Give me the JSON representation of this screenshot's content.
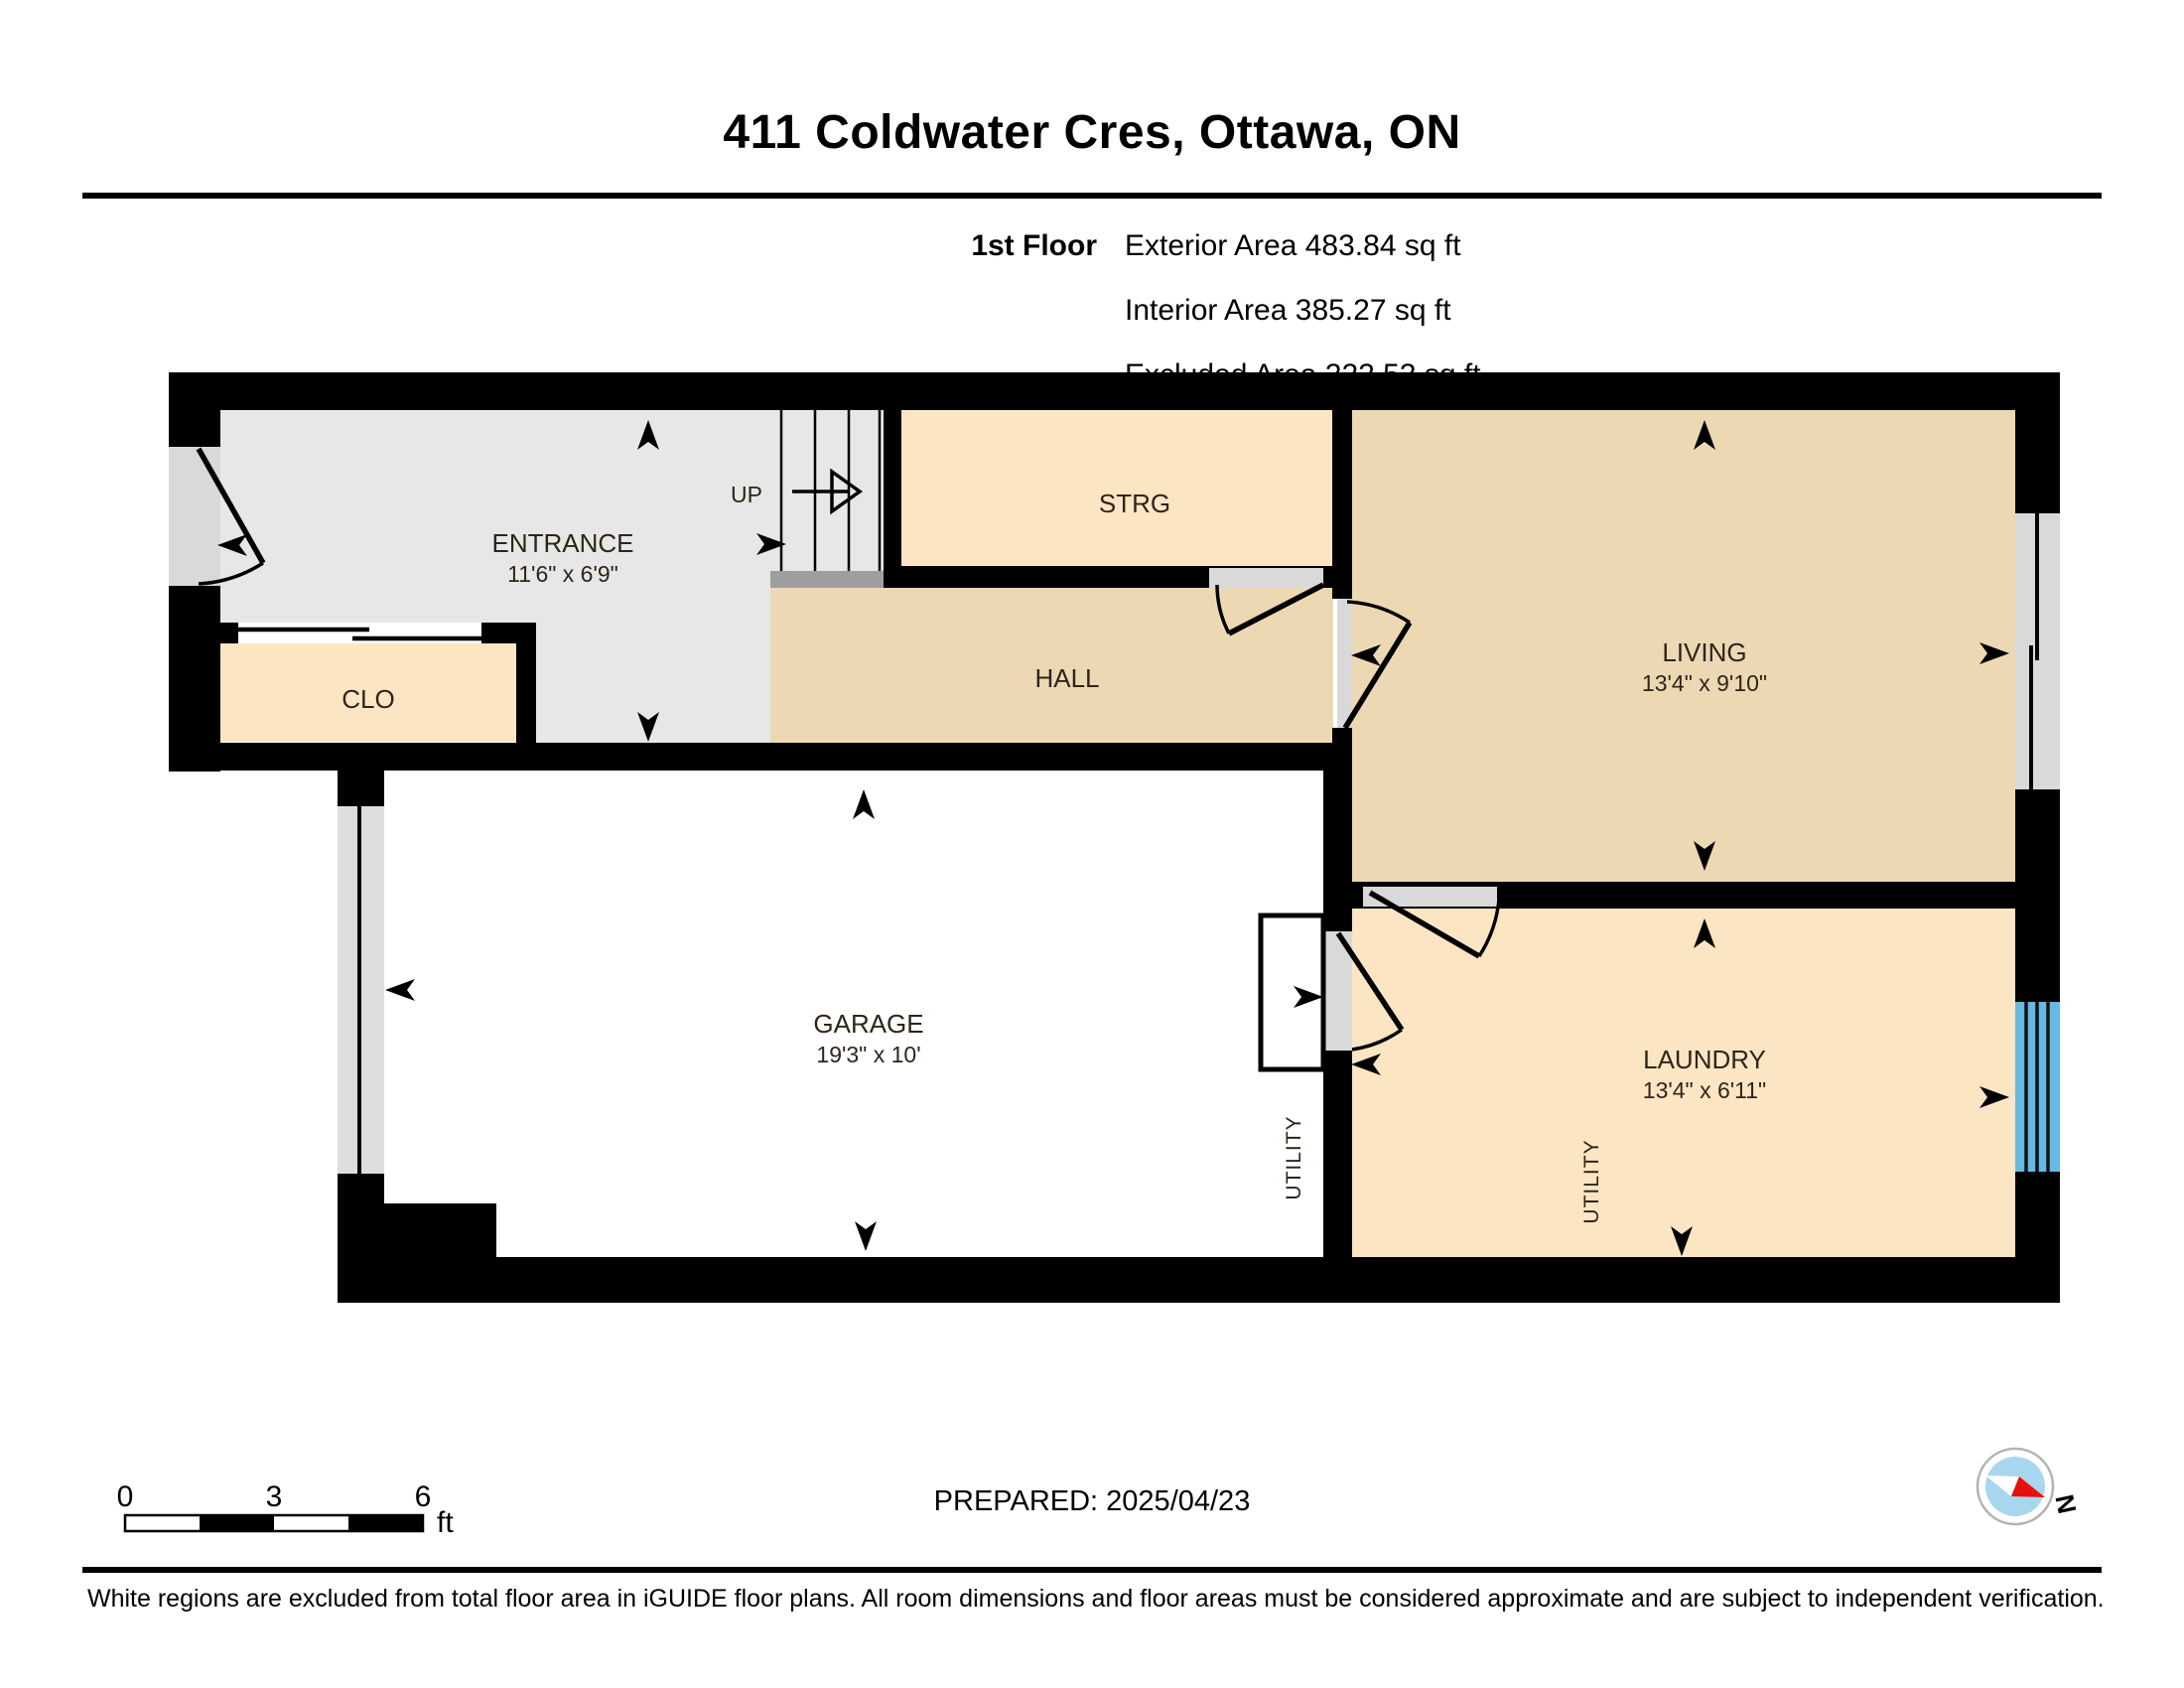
{
  "header": {
    "title": "411 Coldwater Cres, Ottawa, ON",
    "floor_label": "1st Floor",
    "area_lines": [
      "Exterior Area 483.84 sq ft",
      "Interior Area 385.27 sq ft",
      "Excluded Area 222.53 sq ft"
    ]
  },
  "plan": {
    "rooms": {
      "entrance": {
        "name": "ENTRANCE",
        "dims": "11'6\" x 6'9\""
      },
      "clo": {
        "name": "CLO"
      },
      "strg": {
        "name": "STRG"
      },
      "hall": {
        "name": "HALL"
      },
      "living": {
        "name": "LIVING",
        "dims": "13'4\" x 9'10\""
      },
      "garage": {
        "name": "GARAGE",
        "dims": "19'3\" x 10'"
      },
      "laundry": {
        "name": "LAUNDRY",
        "dims": "13'4\" x 6'11\""
      }
    },
    "stairs_label": "UP",
    "utility_labels": {
      "garage": "UTILITY",
      "laundry": "UTILITY"
    }
  },
  "footer": {
    "scale_bar": {
      "ticks": [
        "0",
        "3",
        "6"
      ],
      "unit": "ft"
    },
    "prepared": "PREPARED: 2025/04/23",
    "compass": {
      "north_label": "N"
    },
    "disclaimer": "White regions are excluded from total floor area in iGUIDE floor plans. All room dimensions and floor areas must be considered approximate and are subject to independent verification."
  },
  "colors": {
    "wall": "#000000",
    "floor_gray": "#e7e7e7",
    "floor_peach": "#fce5c2",
    "floor_tan": "#ecd9b3",
    "floor_excluded": "#ffffff",
    "threshold_gray": "#d9d9d9",
    "stair_landing": "#9e9e9e",
    "window_blue": "#66b9e2",
    "compass_red": "#e8100c",
    "compass_blue": "#a9d6ef"
  }
}
